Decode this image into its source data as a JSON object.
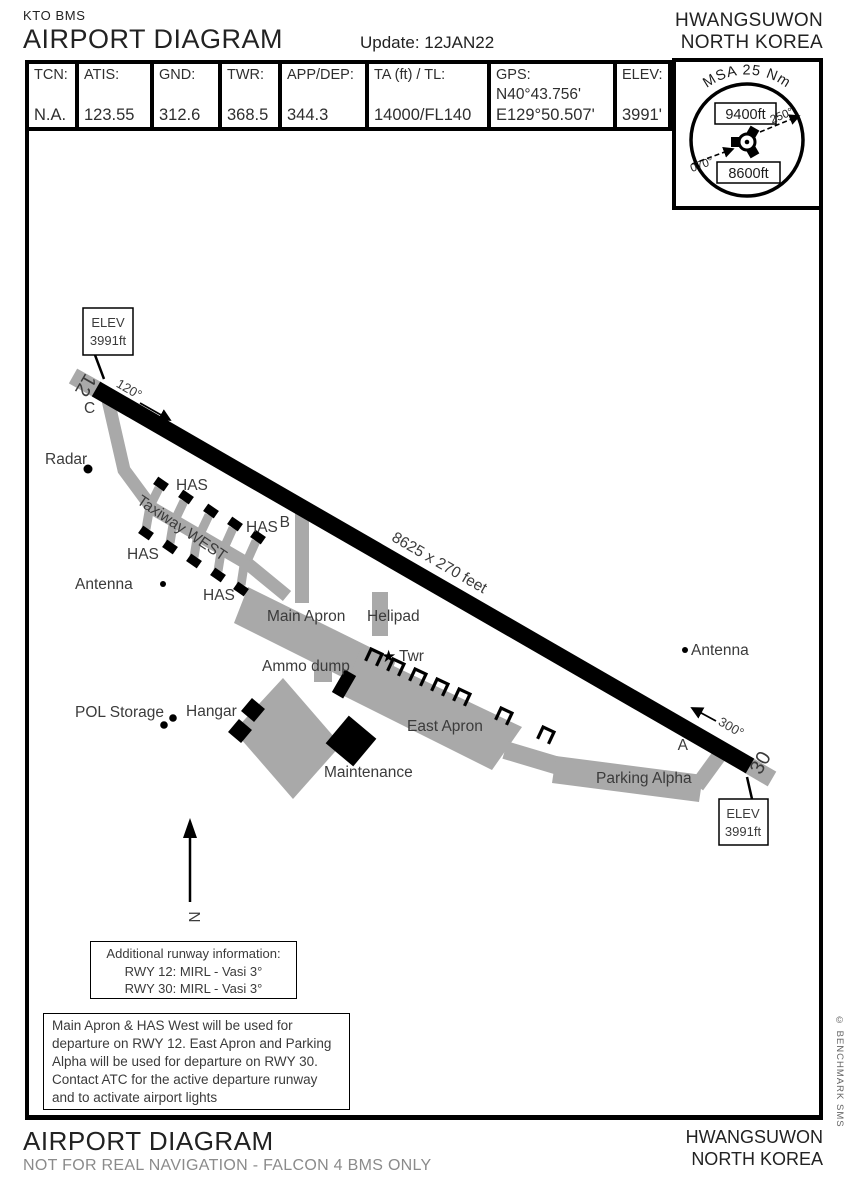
{
  "header": {
    "brand": "KTO BMS",
    "title": "AIRPORT DIAGRAM",
    "update": "Update: 12JAN22",
    "airport": "HWANGSUWON",
    "country": "NORTH KOREA"
  },
  "info_table": {
    "tcn_label": "TCN:",
    "tcn_value": "N.A.",
    "atis_label": "ATIS:",
    "atis_value": "123.55",
    "gnd_label": "GND:",
    "gnd_value": "312.6",
    "twr_label": "TWR:",
    "twr_value": "368.5",
    "appdep_label": "APP/DEP:",
    "appdep_value": "344.3",
    "tatl_label": "TA (ft) / TL:",
    "tatl_value": "14000/FL140",
    "gps_label": "GPS:",
    "gps_lat": "N40°43.756'",
    "gps_lon": "E129°50.507'",
    "elev_label": "ELEV:",
    "elev_value": "3991'"
  },
  "msa": {
    "title": "MSA 25 Nm",
    "upper_alt": "9400ft",
    "lower_alt": "8600ft",
    "bearing_070": "070°",
    "bearing_250": "250°"
  },
  "map": {
    "elev_nw_line1": "ELEV",
    "elev_nw_line2": "3991ft",
    "elev_se_line1": "ELEV",
    "elev_se_line2": "3991ft",
    "rwy12_number": "12",
    "rwy30_number": "30",
    "heading_120": "120°",
    "heading_300": "300°",
    "runway_dimensions": "8625 x 270 feet",
    "taxiway_west": "Taxiway WEST",
    "taxiway_a": "A",
    "taxiway_b": "B",
    "taxiway_c": "C",
    "radar": "Radar",
    "antenna_west": "Antenna",
    "antenna_east": "Antenna",
    "has_ne": "HAS",
    "has_e": "HAS",
    "has_sw": "HAS",
    "has_s": "HAS",
    "main_apron": "Main Apron",
    "helipad": "Helipad",
    "tower_star": "★",
    "tower": "Twr",
    "ammo_dump": "Ammo dump",
    "pol_storage": "POL Storage",
    "hangar": "Hangar",
    "maintenance": "Maintenance",
    "east_apron": "East Apron",
    "parking_alpha": "Parking Alpha",
    "north": "N"
  },
  "runway_info_box": {
    "title": "Additional runway information:",
    "rwy12": "RWY 12: MIRL - Vasi 3°",
    "rwy30": "RWY 30: MIRL - Vasi 3°"
  },
  "note_box": {
    "lines": [
      "Main Apron & HAS West will be used for",
      "departure on RWY 12. East Apron and Parking",
      "Alpha will be used for departure on RWY 30.",
      "Contact ATC for the active departure runway",
      "and to activate airport lights"
    ]
  },
  "footer": {
    "title": "AIRPORT DIAGRAM",
    "disclaimer": "NOT FOR REAL NAVIGATION - FALCON 4 BMS ONLY",
    "airport": "HWANGSUWON",
    "country": "NORTH KOREA"
  },
  "credit": "© BENCHMARK SMS",
  "colors": {
    "apron_gray": "#a9a9a9",
    "runway_black": "#000000"
  }
}
